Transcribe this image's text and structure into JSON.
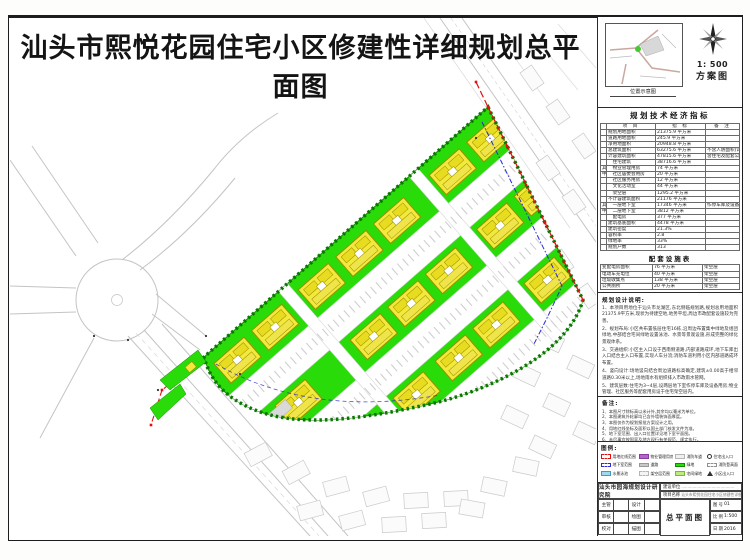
{
  "sheet": {
    "title": "汕头市熙悦花园住宅小区修建性详细规划总平面图"
  },
  "corner": {
    "locmap_caption": "位置示意图",
    "scale": "1: 500",
    "drawing_type": "方案图"
  },
  "indicators": {
    "title": "规划技术经济指标",
    "columns": [
      "项  目",
      "指  标",
      "备  注"
    ],
    "rows": [
      {
        "grp": "",
        "item": "规划用地面积",
        "value": "21375.9 平方米",
        "note": ""
      },
      {
        "grp": "",
        "item": "道路用地面积",
        "value": "245.9 平方米",
        "note": ""
      },
      {
        "grp": "",
        "item": "净用地面积",
        "value": "20948.8 平方米",
        "note": ""
      },
      {
        "grp": "",
        "item": "总建筑面积",
        "value": "63275.6 平方米",
        "note": "不含人防面积(详见说明)"
      },
      {
        "grp": "",
        "item": "计容建筑面积",
        "value": "47815.6 平方米",
        "note": "含住宅及配套公建 详见说明"
      },
      {
        "grp": "",
        "item": "　住宅建筑",
        "value": "38716.6 平方米",
        "note": ""
      },
      {
        "grp": "其",
        "item": "　物业管理用房",
        "value": "74 平方米",
        "note": ""
      },
      {
        "grp": "中",
        "item": "　社区居委会用房",
        "value": "20 平方米",
        "note": ""
      },
      {
        "grp": "",
        "item": "　社区服务用房",
        "value": "12 平方米",
        "note": ""
      },
      {
        "grp": "",
        "item": "　文化活动室",
        "value": "44 平方米",
        "note": ""
      },
      {
        "grp": "",
        "item": "　架空层",
        "value": "1295.2 平方米",
        "note": ""
      },
      {
        "grp": "",
        "item": "不计容建筑面积",
        "value": "21176 平方米",
        "note": ""
      },
      {
        "grp": "其",
        "item": "　一层地下室",
        "value": "17346 平方米",
        "note": "作停车库及设备用房"
      },
      {
        "grp": "中",
        "item": "　二层地下室",
        "value": "3812 平方米",
        "note": ""
      },
      {
        "grp": "",
        "item": "　配电房",
        "value": "377 平方米",
        "note": ""
      },
      {
        "grp": "",
        "item": "建筑基底面积",
        "value": "4478 平方米",
        "note": ""
      },
      {
        "grp": "",
        "item": "建筑密度",
        "value": "21.3%",
        "note": ""
      },
      {
        "grp": "",
        "item": "容积率",
        "value": "2.8",
        "note": ""
      },
      {
        "grp": "",
        "item": "绿地率",
        "value": "33%",
        "note": ""
      },
      {
        "grp": "",
        "item": "规划户数",
        "value": "313",
        "note": ""
      }
    ]
  },
  "facilities": {
    "title": "配套设施表",
    "rows": [
      {
        "item": "变配电房面积",
        "value": "76 平方米",
        "note": "架空层"
      },
      {
        "item": "电动车充电位",
        "value": "40 平方米",
        "note": "架空层"
      },
      {
        "item": "垃圾收集点",
        "value": "138 平方米",
        "note": "架空层"
      },
      {
        "item": "公共厕所",
        "value": "20 平方米",
        "note": "架空层"
      }
    ]
  },
  "design_notes": {
    "title": "规划设计说明:",
    "items": [
      "1、本项目用地位于汕头市龙湖区,东北侧临规划路,规划总用地面积21375.9平方米,现状为待建空地,地势平坦,周边市政配套设施较为完善。",
      "2、规划布局:小区共布置低层住宅16栋,沿周边布置集中绿地及组团绿地,中部结合宅间绿地设置泳池、水景等景观设施,形成完整的绿化景观体系。",
      "3、交通组织:小区主入口设于西南侧道路,内部道路成环,地下车库出入口结合主入口布置,实现人车分流;消防车道利用小区内部道路成环布置。",
      "4、竖向设计:场地竖向结合周边道路标高确定,建筑±0.00高于相邻道路0.30米以上,场地雨水有组织排入市政雨水管网。",
      "5、建筑层数:住宅为3~4层,设两层地下室作停车库及设备用房;物业管理、社区服务等配套用房设于住宅架空层内。"
    ]
  },
  "remarks": {
    "title": "备注:",
    "items": [
      "1、本图尺寸除标高以米计外,其余均以毫米为单位。",
      "2、本图建筑外轮廓均已含外墙装饰面厚度。",
      "3、本图仅作为规划报批方案设计之用。",
      "4、用地红线坐标及面积以国土部门核发文件为准。",
      "5、地下室范围、出入口位置详见地下室平面图。",
      "6、未尽事宜按国家及地方现行有关规范、规定执行。"
    ]
  },
  "legend": {
    "title": "图例:",
    "items": [
      {
        "label": "用地红线范围",
        "cls": "sw s-redline"
      },
      {
        "label": "物业管理用房",
        "cls": "sw s-purple"
      },
      {
        "label": "消防车道",
        "cls": "sw s-road"
      },
      {
        "label": "住宅出入口",
        "cls": "sw s-dot"
      },
      {
        "label": "地下室范围",
        "cls": "sw s-bluedash"
      },
      {
        "label": "道路",
        "cls": "sw s-gray"
      },
      {
        "label": "绿地",
        "cls": "sw s-green"
      },
      {
        "label": "消防登高面",
        "cls": "sw s-whitedash"
      },
      {
        "label": "水景泳池",
        "cls": "sw s-cyan"
      },
      {
        "label": "架空层范围",
        "cls": "sw s-graydash"
      },
      {
        "label": "宅间绿地",
        "cls": "sw s-lgreen"
      },
      {
        "label": "小区出入口",
        "cls": "sw s-gate"
      }
    ]
  },
  "titleblock": {
    "institute": "汕头市园海规划设计研究院",
    "owner_label": "建设单位",
    "owner_value": "……………………………………",
    "project_label": "项目名称",
    "project_value": "汕头市熙悦花园住宅小区修建性详细规划",
    "drawing_name": "总平面图",
    "left_rows": [
      {
        "a": "主管",
        "b": "设计"
      },
      {
        "a": "审核",
        "b": "绘图"
      },
      {
        "a": "校对",
        "b": "描图"
      }
    ],
    "fields": [
      {
        "k": "图 号",
        "v": "01"
      },
      {
        "k": "比 例",
        "v": "1:500"
      },
      {
        "k": "日 期",
        "v": "2016"
      }
    ]
  },
  "colors": {
    "site_green": "#2adb0a",
    "tree_green": "#0a7800",
    "building_yellow": "#f2e93c",
    "pool_blue": "#9fd8ef",
    "redline": "#e01010",
    "basement_blue": "#2b2bd0",
    "road_gray": "#c4c4c4"
  }
}
